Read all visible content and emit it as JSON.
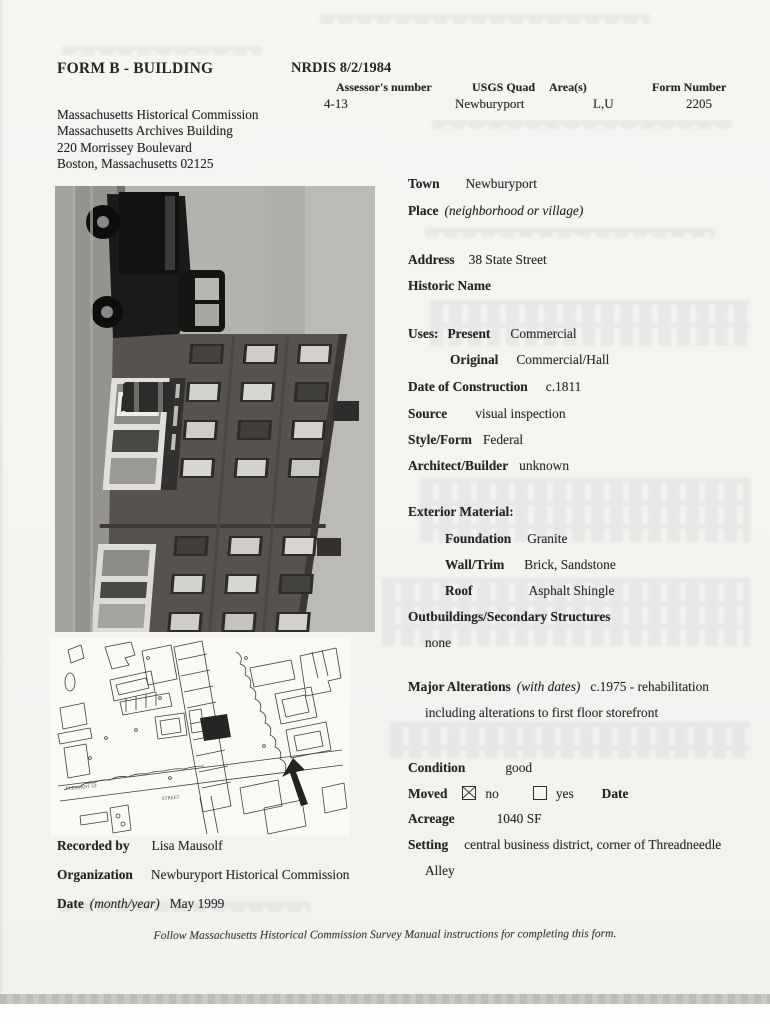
{
  "header": {
    "form_title": "FORM B - BUILDING",
    "nrdis": "NRDIS 8/2/1984",
    "columns": [
      {
        "label": "Assessor's number",
        "value": "4-13"
      },
      {
        "label": "USGS Quad",
        "value": "Newburyport"
      },
      {
        "label": "Area(s)",
        "value": "L,U"
      },
      {
        "label": "Form Number",
        "value": "2205"
      }
    ],
    "agency": {
      "line1": "Massachusetts Historical Commission",
      "line2": "Massachusetts Archives Building",
      "line3": "220 Morrissey Boulevard",
      "line4": "Boston, Massachusetts 02125"
    }
  },
  "details": {
    "town": {
      "label": "Town",
      "value": "Newburyport"
    },
    "place": {
      "label": "Place",
      "note": "(neighborhood or village)"
    },
    "address": {
      "label": "Address",
      "value": "38 State Street"
    },
    "historic_name": {
      "label": "Historic Name"
    },
    "uses": {
      "label": "Uses:",
      "present_label": "Present",
      "present_value": "Commercial",
      "original_label": "Original",
      "original_value": "Commercial/Hall"
    },
    "date_of_construction": {
      "label": "Date of Construction",
      "value": "c.1811"
    },
    "source": {
      "label": "Source",
      "value": "visual inspection"
    },
    "style_form": {
      "label": "Style/Form",
      "value": "Federal"
    },
    "architect": {
      "label": "Architect/Builder",
      "value": "unknown"
    },
    "exterior": {
      "label": "Exterior Material:"
    },
    "foundation": {
      "label": "Foundation",
      "value": "Granite"
    },
    "wall_trim": {
      "label": "Wall/Trim",
      "value": "Brick, Sandstone"
    },
    "roof": {
      "label": "Roof",
      "value": "Asphalt Shingle"
    },
    "outbuildings": {
      "label": "Outbuildings/Secondary Structures",
      "value": "none"
    },
    "alterations": {
      "label": "Major Alterations",
      "note": "(with dates)",
      "value": "c.1975 - rehabilitation",
      "value_line2": "including alterations to first floor storefront"
    },
    "condition": {
      "label": "Condition",
      "value": "good"
    },
    "moved": {
      "label": "Moved",
      "no_label": "no",
      "yes_label": "yes",
      "no_checked": true,
      "yes_checked": false,
      "date_label": "Date"
    },
    "acreage": {
      "label": "Acreage",
      "value": "1040 SF"
    },
    "setting": {
      "label": "Setting",
      "value": "central business district, corner of Threadneedle",
      "value_line2": "Alley"
    }
  },
  "recording": {
    "recorded_by": {
      "label": "Recorded by",
      "value": "Lisa Mausolf"
    },
    "organization": {
      "label": "Organization",
      "value": "Newburyport Historical Commission"
    },
    "date": {
      "label": "Date",
      "note": "(month/year)",
      "value": "May 1999"
    }
  },
  "footer": {
    "instruction": "Follow Massachusetts Historical Commission Survey Manual instructions for completing this form."
  },
  "map": {
    "labels": {
      "pleasant": "PLEASANT ST",
      "street": "STREET"
    }
  },
  "colors": {
    "paper": "#f5f4f1",
    "ink": "#262626",
    "photo_gray": "#b9b7b3"
  }
}
